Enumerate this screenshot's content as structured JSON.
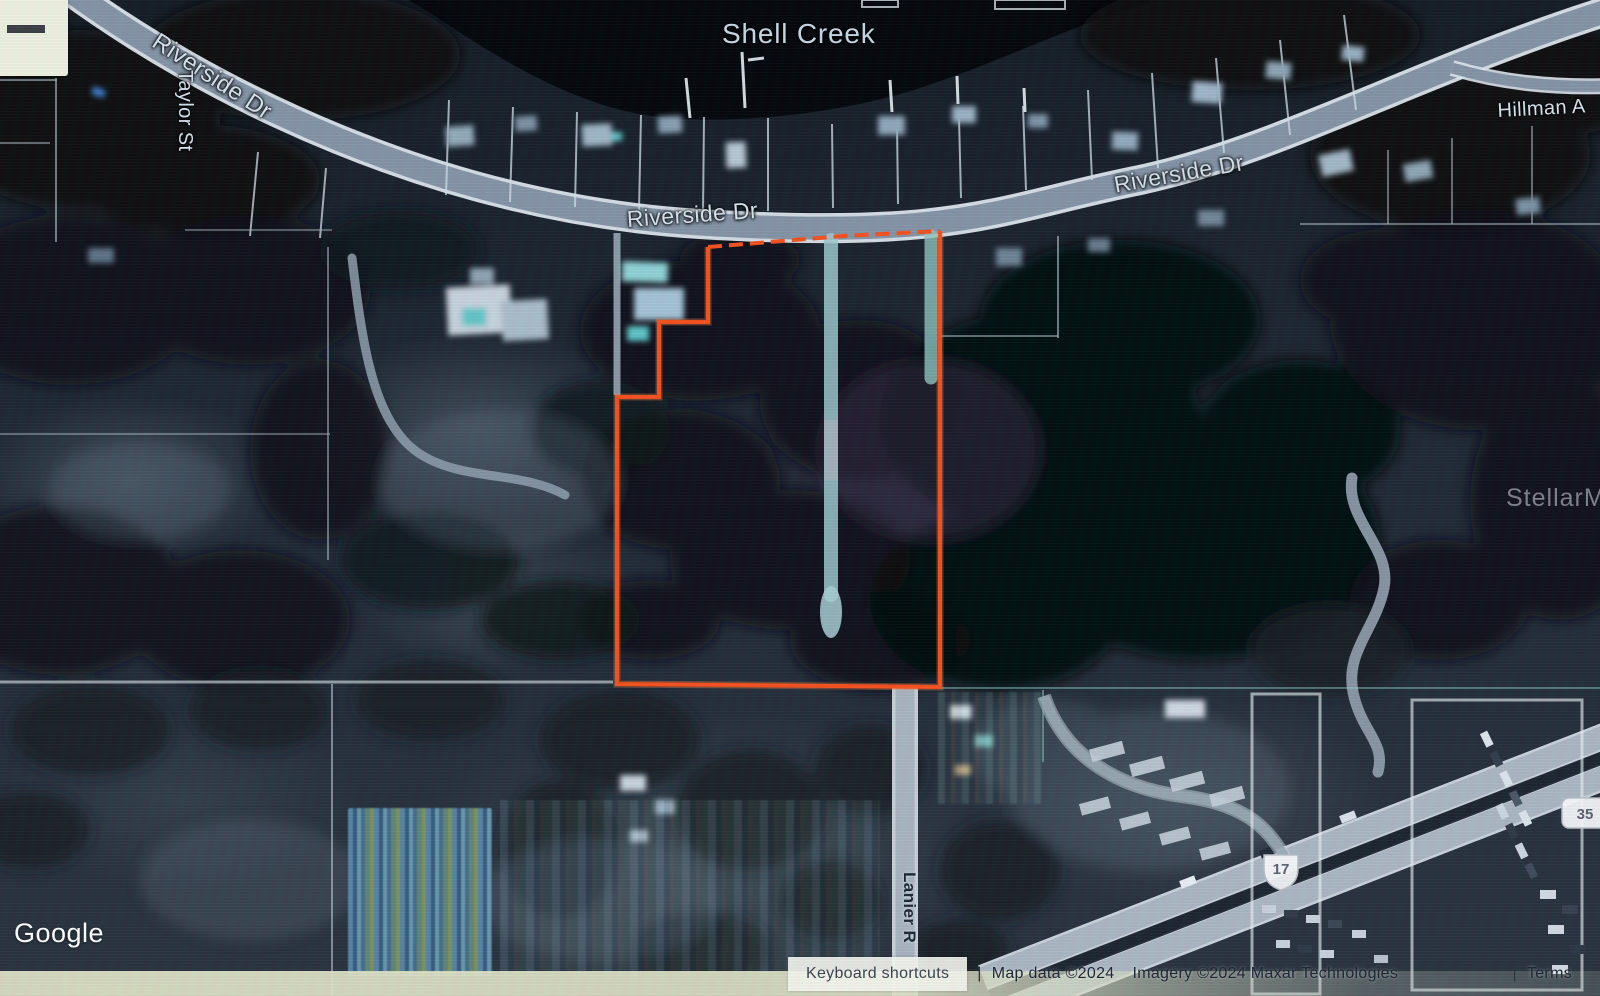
{
  "map_labels": {
    "water": "Shell Creek",
    "roads": [
      {
        "id": "riverside-left",
        "text": "Riverside Dr"
      },
      {
        "id": "riverside-center",
        "text": "Riverside Dr"
      },
      {
        "id": "riverside-right",
        "text": "Riverside Dr"
      },
      {
        "id": "taylor",
        "text": "Taylor St"
      },
      {
        "id": "hillman",
        "text": "Hillman A"
      },
      {
        "id": "lanier",
        "text": "Lanier R"
      }
    ]
  },
  "route_shields": {
    "us_17": "17",
    "fl_35": "35"
  },
  "parcel": {
    "outline_color": "#f4511e"
  },
  "watermark": {
    "text": "StellarMLS"
  },
  "branding": {
    "logo": "Google"
  },
  "controls": {
    "zoom_out_icon": "minus"
  },
  "attribution": {
    "keyboard_shortcuts": "Keyboard shortcuts",
    "separator": "|",
    "map_data": "Map data ©2024",
    "imagery": "Imagery ©2024 Maxar Technologies",
    "terms": "Terms"
  }
}
